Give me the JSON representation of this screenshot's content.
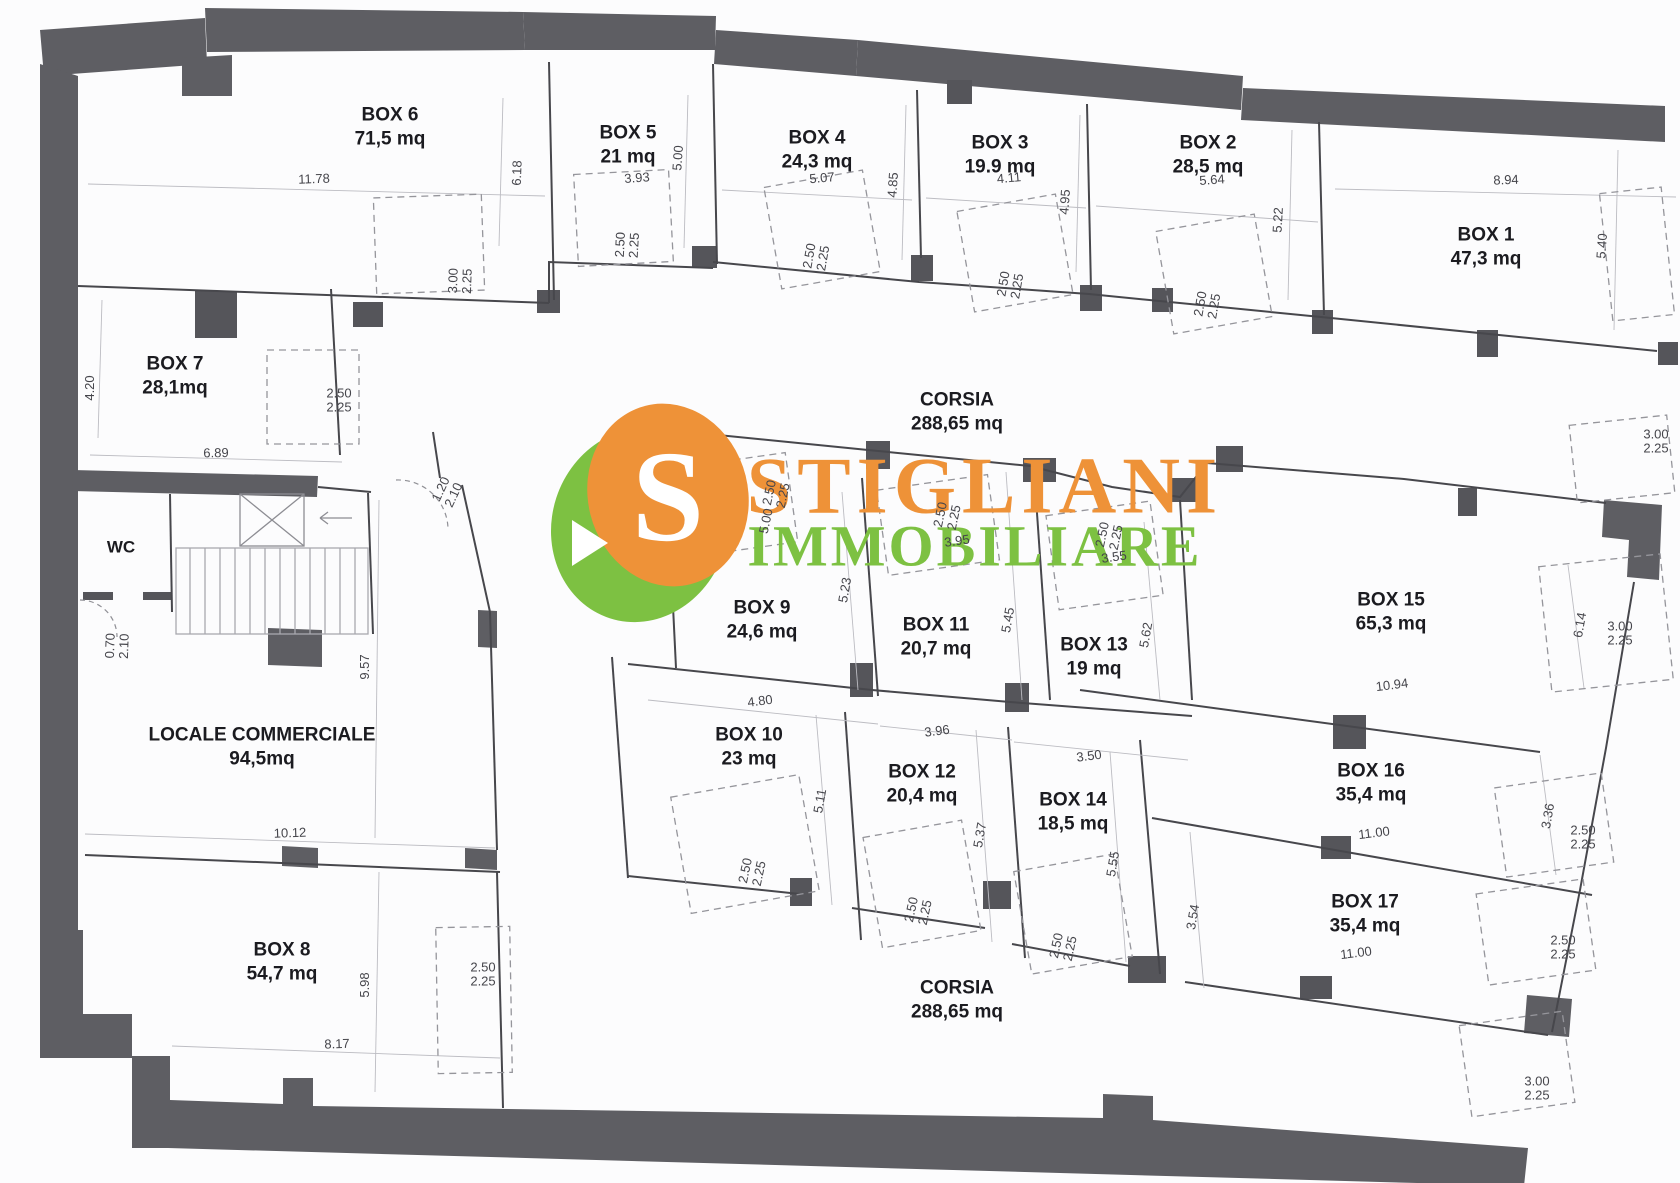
{
  "logo": {
    "monogram": "S",
    "title": "STIGLIANI",
    "subtitle": "IMMOBILIARE",
    "orange": "#EE9238",
    "green": "#7DC142"
  },
  "palette": {
    "wall": "#5E5E63",
    "thin_line": "#47474C",
    "dashed_line": "#95959B",
    "dim_text": "#45454B"
  },
  "rooms": [
    {
      "name": "BOX 6",
      "area": "71,5 mq"
    },
    {
      "name": "BOX 5",
      "area": "21 mq"
    },
    {
      "name": "BOX 4",
      "area": "24,3 mq"
    },
    {
      "name": "BOX 3",
      "area": "19.9 mq"
    },
    {
      "name": "BOX 2",
      "area": "28,5 mq"
    },
    {
      "name": "BOX 1",
      "area": "47,3 mq"
    },
    {
      "name": "BOX 7",
      "area": "28,1mq"
    },
    {
      "name": "WC",
      "area": ""
    },
    {
      "name": "LOCALE COMMERCIALE",
      "area": "94,5mq"
    },
    {
      "name": "BOX 8",
      "area": "54,7 mq"
    },
    {
      "name": "CORSIA",
      "area": "288,65 mq"
    },
    {
      "name": "BOX 9",
      "area": "24,6 mq"
    },
    {
      "name": "BOX 11",
      "area": "20,7 mq"
    },
    {
      "name": "BOX 13",
      "area": "19 mq"
    },
    {
      "name": "BOX 10",
      "area": "23 mq"
    },
    {
      "name": "BOX 12",
      "area": "20,4 mq"
    },
    {
      "name": "BOX 14",
      "area": "18,5 mq"
    },
    {
      "name": "BOX 15",
      "area": "65,3 mq"
    },
    {
      "name": "BOX 16",
      "area": "35,4 mq"
    },
    {
      "name": "BOX 17",
      "area": "35,4 mq"
    },
    {
      "name": "CORSIA",
      "area": "288,65 mq"
    }
  ],
  "dims": [
    "11.78",
    "6.18",
    "3.93",
    "5.00",
    "5.07",
    "4.85",
    "4.11",
    "4.95",
    "5.64",
    "5.22",
    "8.94",
    "5.40",
    "3.00\n2.25",
    "3.00\n2.25",
    "2.50\n2.25",
    "2.50\n2.25",
    "2.50\n2.25",
    "2.50\n2.25",
    "4.20",
    "6.89",
    "2.50\n2.25",
    "1.20\n2.10",
    "9.57",
    "0.70\n2.10",
    "10.12",
    "5.98",
    "8.17",
    "2.50\n2.25",
    "2.50\n2.25",
    "5.00",
    "5.23",
    "2.50\n2.25",
    "3.95",
    "2.50\n2.25",
    "3.55",
    "5.45",
    "5.62",
    "4.80",
    "3.96",
    "3.50",
    "5.11",
    "5.37",
    "5.55",
    "2.50\n2.25",
    "2.50\n2.25",
    "2.50\n2.25",
    "3.54",
    "10.94",
    "6.14",
    "3.00\n2.25",
    "11.00",
    "3.36",
    "2.50\n2.25",
    "2.50\n2.25",
    "11.00",
    "3.00\n2.25"
  ]
}
